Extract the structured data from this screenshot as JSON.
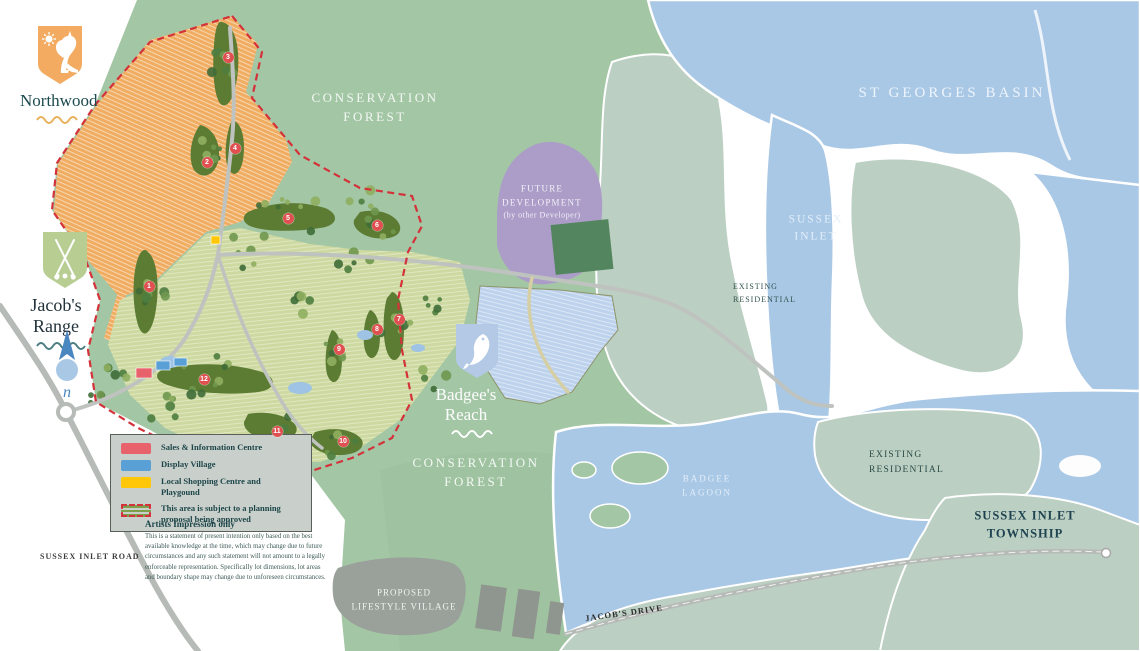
{
  "brand": {
    "northwood": "Northwood",
    "jacobs_range": "Jacob's Range",
    "badgees_reach": "Badgee's Reach",
    "north_letter": "n"
  },
  "labels": {
    "conservation_forest_top": {
      "lines": [
        "CONSERVATION",
        "FOREST"
      ]
    },
    "st_georges_basin": "ST GEORGES BASIN",
    "future_development": {
      "lines": [
        "FUTURE",
        "DEVELOPMENT",
        "(by other Developer)"
      ]
    },
    "sussex_inlet": {
      "lines": [
        "SUSSEX",
        "INLET"
      ]
    },
    "existing_residential_1": {
      "lines": [
        "EXISTING",
        "RESIDENTIAL"
      ]
    },
    "conservation_forest_bottom": {
      "lines": [
        "CONSERVATION",
        "FOREST"
      ]
    },
    "badgee_lagoon": {
      "lines": [
        "BADGEE",
        "LAGOON"
      ]
    },
    "existing_residential_2": {
      "lines": [
        "EXISTING",
        "RESIDENTIAL"
      ]
    },
    "sussex_inlet_township": {
      "lines": [
        "SUSSEX INLET",
        "TOWNSHIP"
      ]
    },
    "sussex_inlet_road": "SUSSEX INLET ROAD",
    "proposed_lifestyle_village": {
      "lines": [
        "PROPOSED",
        "LIFESTYLE VILLAGE"
      ]
    },
    "jacobs_drive": "JACOB'S DRIVE"
  },
  "legend": {
    "items": [
      {
        "label": "Sales & Information Centre",
        "color": "#e8626c"
      },
      {
        "label": "Display Village",
        "color": "#58a0d6"
      },
      {
        "label": "Local Shopping Centre and Playgound",
        "color": "#ffc708"
      },
      {
        "label": "This area is subject to a planning proposal being approved",
        "color": "#d4323a"
      }
    ]
  },
  "disclaimer": {
    "title": "Artists Impression only",
    "body": "This is a statement of present intention only based on the best available knowledge at the time, which may change due to future circumstances and any such statement will not amount to a legally enforceable representation. Specifically lot dimensions, lot areas and boundary shape may change due to unforeseen circumstances."
  },
  "golf_holes": [
    {
      "n": "1",
      "x": 149,
      "y": 286
    },
    {
      "n": "2",
      "x": 207,
      "y": 162
    },
    {
      "n": "3",
      "x": 228,
      "y": 57
    },
    {
      "n": "4",
      "x": 235,
      "y": 148
    },
    {
      "n": "5",
      "x": 288,
      "y": 218
    },
    {
      "n": "6",
      "x": 377,
      "y": 225
    },
    {
      "n": "7",
      "x": 399,
      "y": 319
    },
    {
      "n": "8",
      "x": 377,
      "y": 329
    },
    {
      "n": "9",
      "x": 339,
      "y": 349
    },
    {
      "n": "10",
      "x": 343,
      "y": 441
    },
    {
      "n": "11",
      "x": 277,
      "y": 431
    },
    {
      "n": "12",
      "x": 204,
      "y": 379
    }
  ],
  "colors": {
    "forest": "#a3c6a5",
    "water": "#a9c8e6",
    "residential_sage": "#bccfc3",
    "orange_lots": "#f0ad62",
    "green_lots": "#cdd9a0",
    "blue_lots": "#bdd2ec",
    "future_dev_purple": "#ab9dc8",
    "dark_green_parcel": "#53855e",
    "fairway": "#5d7c33",
    "boundary_red": "#d4323a",
    "sales_red": "#e8626c",
    "display_blue": "#58a0d6",
    "shopping_yellow": "#ffc708",
    "road_gray": "#b7bbb7",
    "brand_text_teal": "#1c4a4e"
  }
}
